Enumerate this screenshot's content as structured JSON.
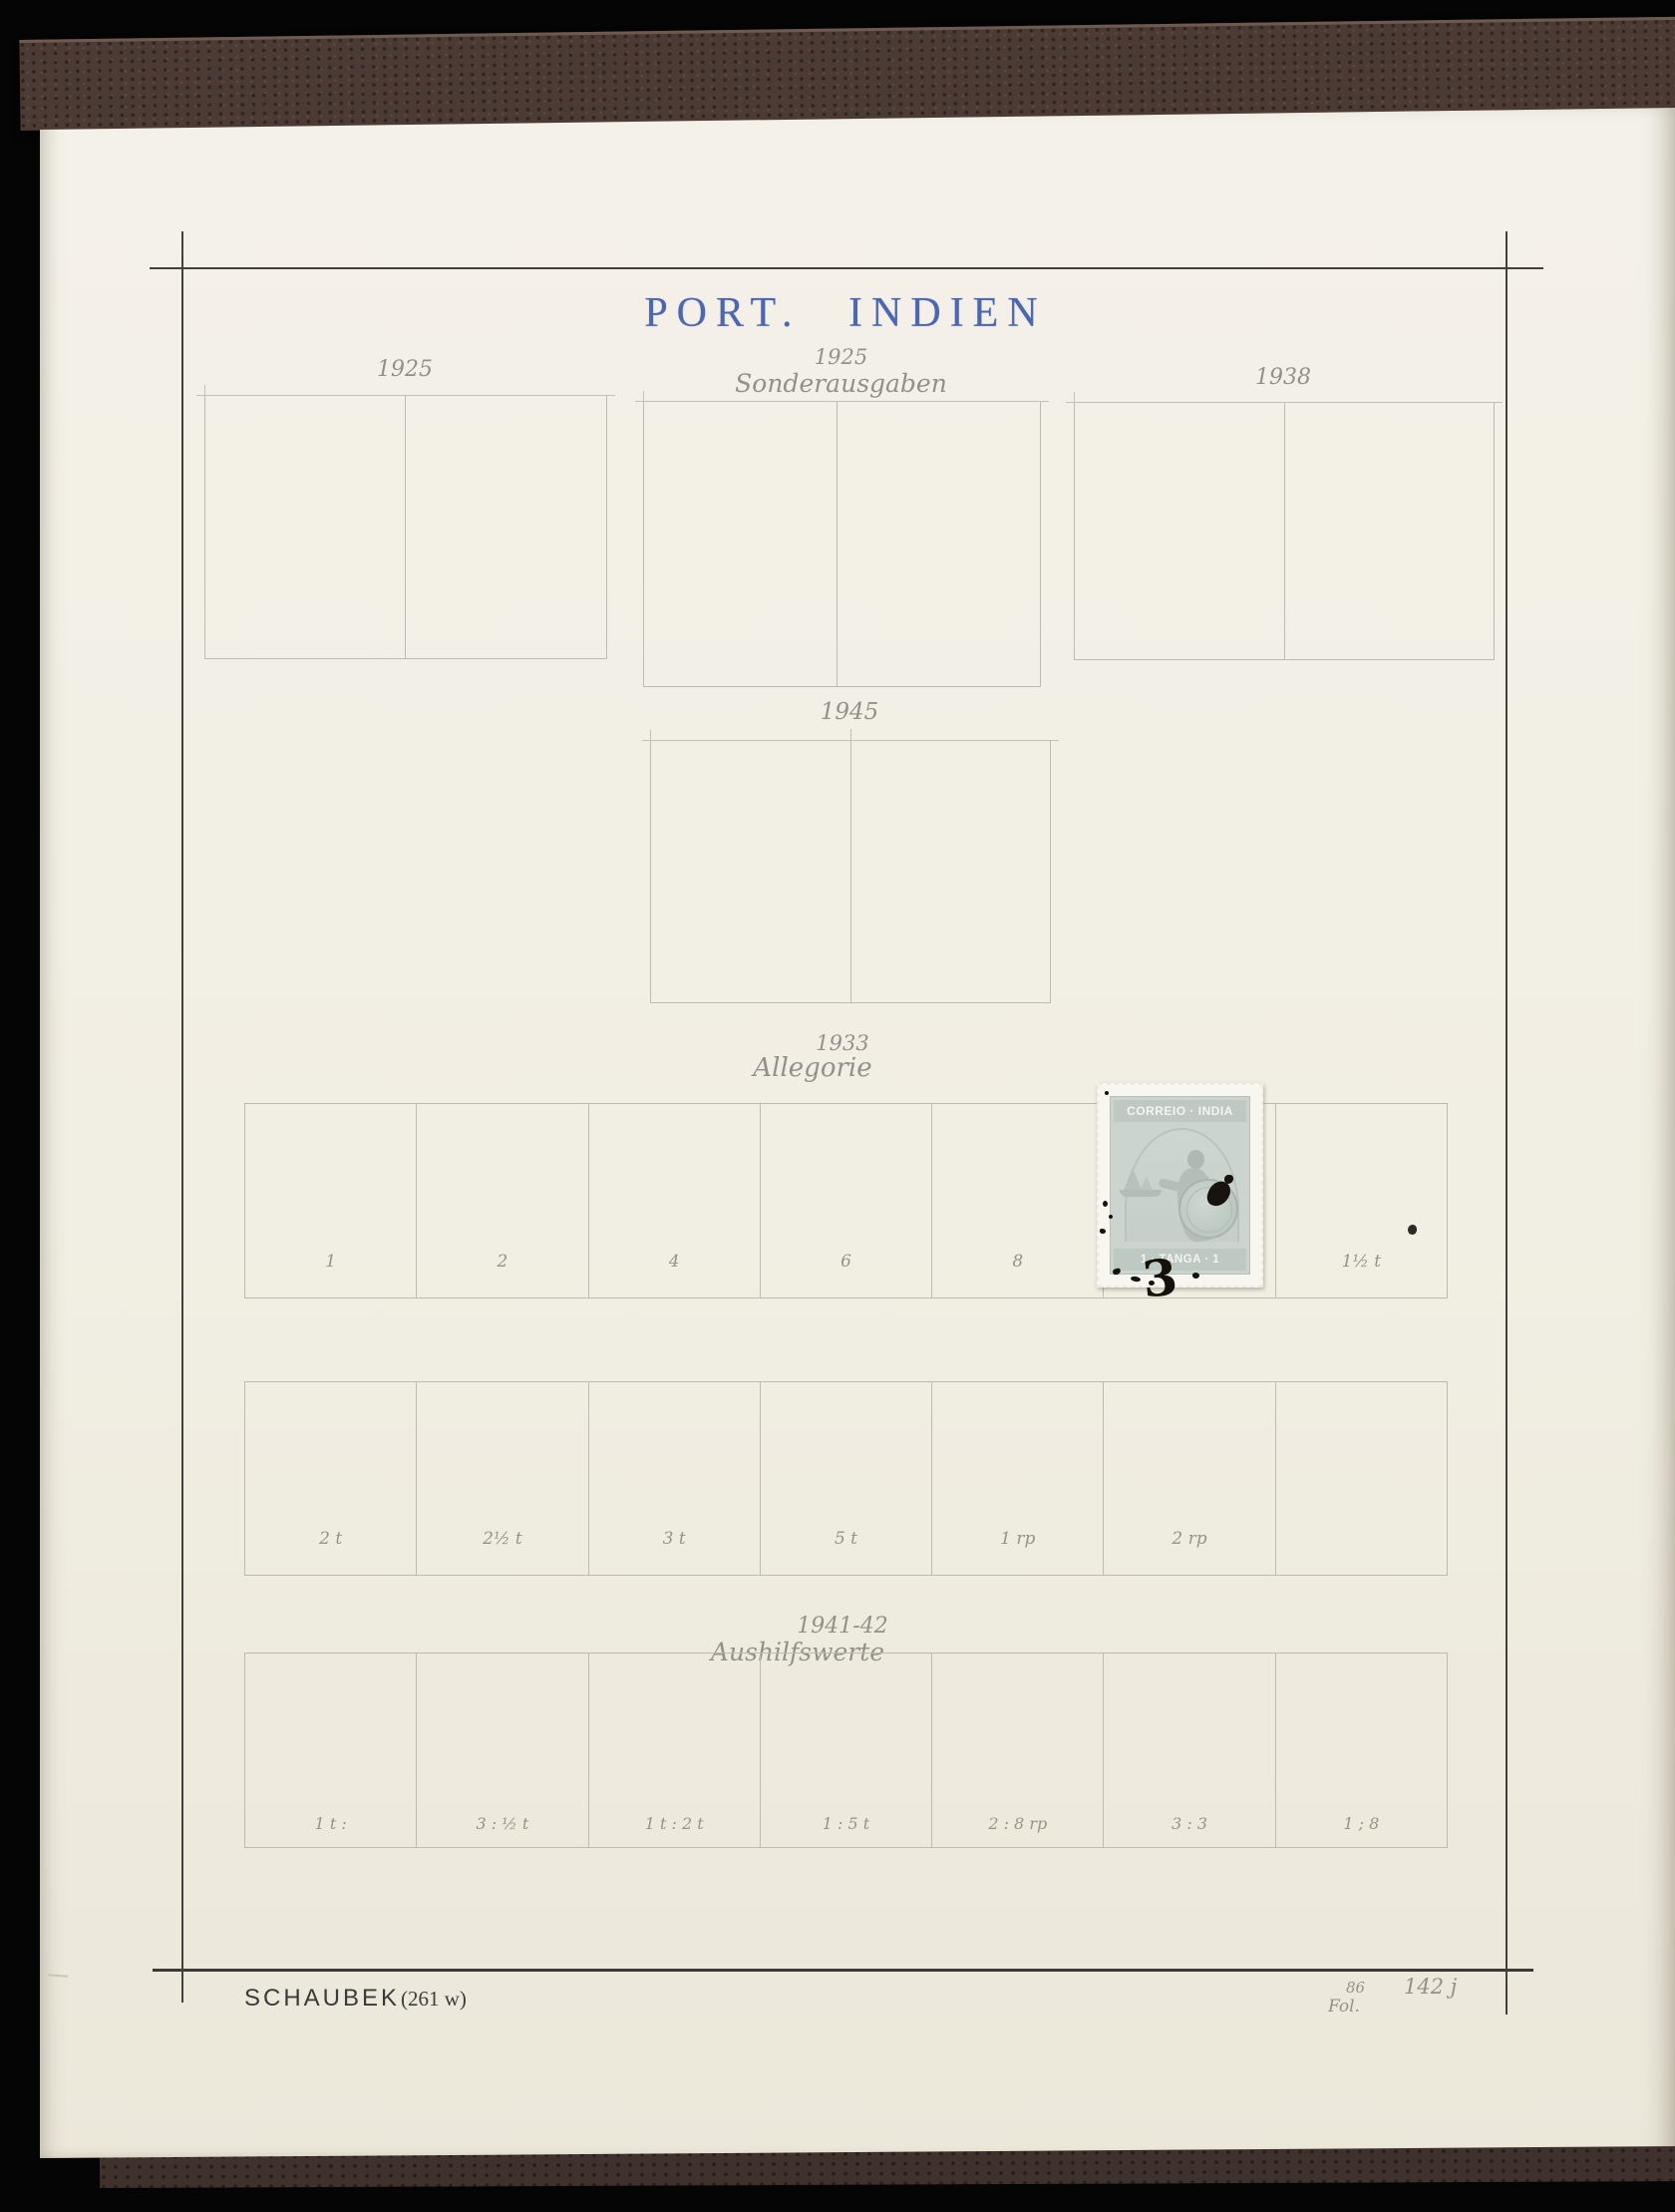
{
  "page": {
    "title": "PORT. INDIEN"
  },
  "colors": {
    "title_ink": "#4b66b4",
    "pencil": "#93908a",
    "paper": "#f1eee3",
    "album_cover": "#4c3b35"
  },
  "groups": {
    "g1925": {
      "year": "1925"
    },
    "g1925s": {
      "year": "1925",
      "subtitle": "Sonderausgaben"
    },
    "g1938": {
      "year": "1938"
    },
    "g1945": {
      "year": "1945"
    },
    "g1933": {
      "year": "1933",
      "subtitle": "Allegorie"
    },
    "g1941": {
      "year": "1941-42",
      "subtitle": "Aushilfswerte"
    }
  },
  "rows": {
    "row1_labels": [
      "1",
      "2",
      "4",
      "6",
      "8",
      "",
      "1½ t"
    ],
    "row2_labels": [
      "2 t",
      "2½ t",
      "3 t",
      "5 t",
      "1 rp",
      "2 rp",
      ""
    ],
    "row3_labels": [
      "1 t :",
      "3 : ½ t",
      "1 t : 2 t",
      "1 : 5 t",
      "2 : 8 rp",
      "3 : 3",
      "1 ; 8"
    ]
  },
  "stamp": {
    "inscription_top": "CORREIO · INDIA",
    "inscription_bottom": "1 · TANGA · 1",
    "ink_numeral": "3"
  },
  "footer": {
    "publisher": "SCHAUBEK",
    "plate": "(261 w)",
    "pencil_small_top": "86",
    "pencil_small_bottom": "Fol.",
    "pencil_number": "142 j"
  }
}
